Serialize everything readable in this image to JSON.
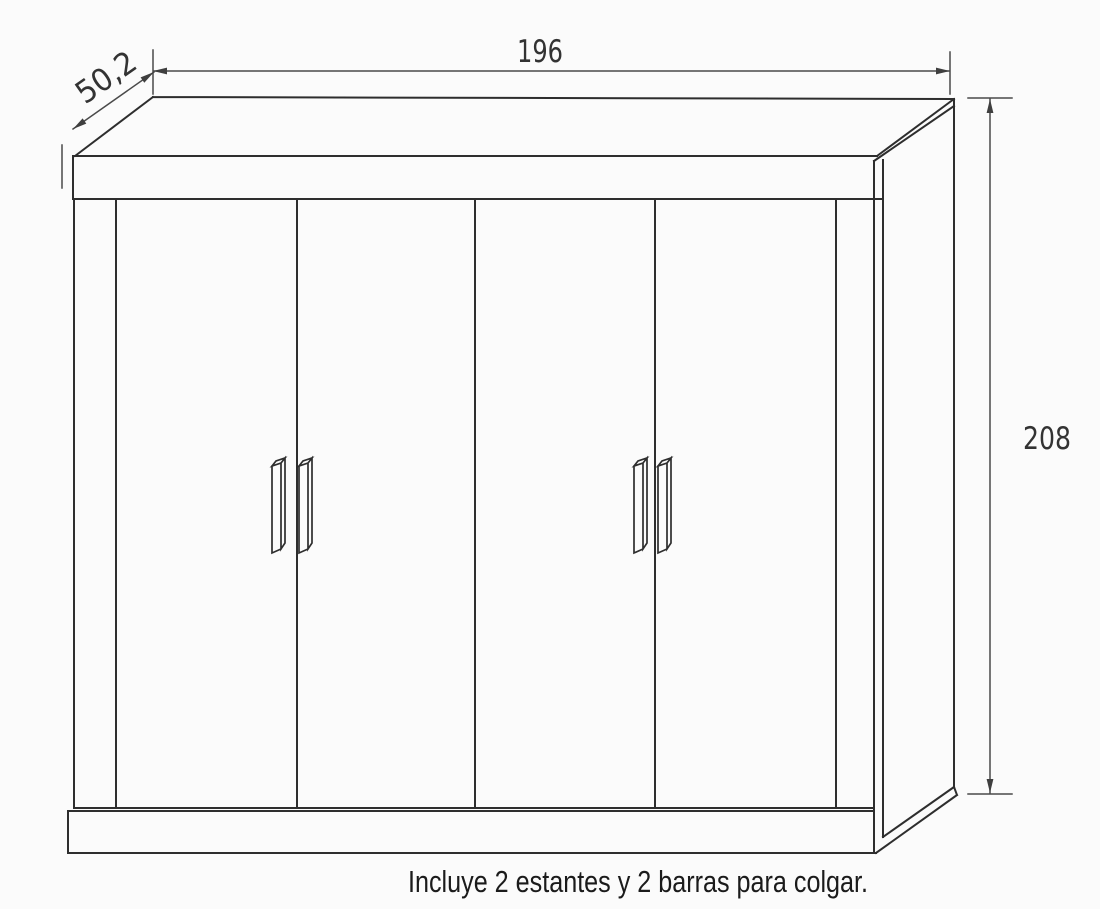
{
  "diagram": {
    "type": "furniture-technical-drawing",
    "object": "four-door-wardrobe",
    "doors_count": 4,
    "handles_count": 4,
    "dimensions": {
      "width": {
        "value": "196"
      },
      "depth": {
        "value": "50,2"
      },
      "height": {
        "value": "208"
      }
    },
    "caption": "Incluye 2 estantes y 2 barras para colgar.",
    "colors": {
      "background": "#fbfbfb",
      "drawing_line": "#2e2e2e",
      "dimension_line": "#4a4a4a",
      "label_text": "#333333",
      "caption_text": "#1b1b1b"
    }
  }
}
